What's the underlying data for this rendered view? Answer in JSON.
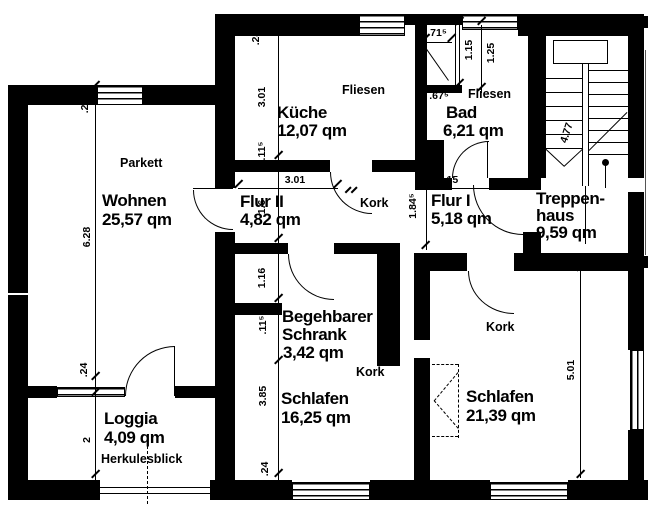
{
  "rooms": {
    "wohnen": {
      "name": "Wohnen",
      "area": "25,57 qm",
      "floor": "Parkett"
    },
    "kueche": {
      "name": "Küche",
      "area": "12,07 qm",
      "floor": "Fliesen"
    },
    "bad": {
      "name": "Bad",
      "area": "6,21 qm",
      "floor": "Fliesen"
    },
    "flur2": {
      "name": "Flur II",
      "area": "4,82 qm",
      "floor": "Kork"
    },
    "flur1": {
      "name": "Flur I",
      "area": "5,18 qm"
    },
    "treppenhaus": {
      "name_line1": "Treppen-",
      "name_line2": "haus",
      "area": "9,59 qm"
    },
    "schrank": {
      "name_line1": "Begehbarer",
      "name_line2": "Schrank",
      "area": "3,42 qm",
      "floor": "Kork"
    },
    "schlafen_links": {
      "name": "Schlafen",
      "area": "16,25 qm"
    },
    "schlafen_rechts": {
      "name": "Schlafen",
      "area": "21,39 qm",
      "floor": "Kork"
    },
    "loggia": {
      "name": "Loggia",
      "area": "4,09 qm",
      "note": "Herkulesblick"
    }
  },
  "dimensions": {
    "left_wall_top": ".24",
    "wohnen_height": "6.28",
    "loggia_wall": ".24",
    "loggia_depth": "2",
    "kueche_wall_top": ".24",
    "kueche_height": "3.01",
    "kueche_sill": ".11⁵",
    "flur2_width": "3.01",
    "wohnen_door": "1.6",
    "schrank_niche": "1.16",
    "schrank_sill": ".11⁵",
    "schlafen_links_height": "3.85",
    "bottom_wall": ".24",
    "bad_niche": ".71⁵",
    "dusche_breite": "1.15",
    "dusche_tiefe": "1.25",
    "bad_vorwand": ".67⁵",
    "flur1_width": "3.15",
    "flur1_height": "1.84⁵",
    "treppe_lauf": "4.77",
    "schlafen_rechts_height": "5.01"
  },
  "colors": {
    "wall": "#000000",
    "background": "#ffffff"
  }
}
